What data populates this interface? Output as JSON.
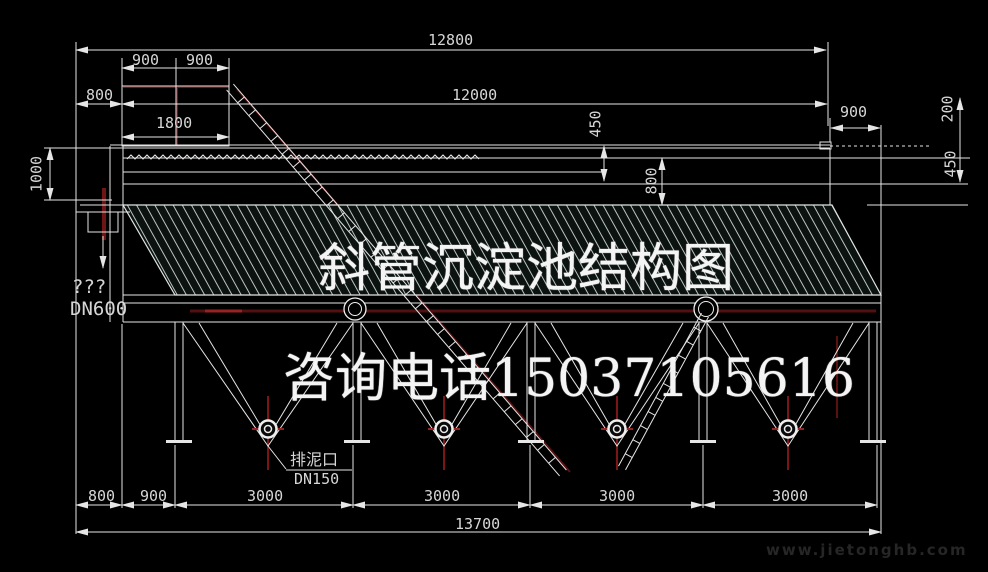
{
  "title": "斜管沉淀池结构图",
  "watermark": {
    "phone": "咨询电话15037105616",
    "site": "www.jietonghb.com"
  },
  "dimensions": {
    "overall_top": "12800",
    "inner_top": "12000",
    "platform_left": "900",
    "platform_right": "900",
    "platform_offset": "800",
    "platform_width": "1800",
    "left_depth": "1000",
    "mid_rim": "450",
    "mid_tube": "800",
    "right_offset": "900",
    "right_freeboard": "200",
    "right_trough": "450",
    "bottom_segments": [
      "800",
      "900",
      "3000",
      "3000",
      "3000",
      "3000"
    ],
    "overall_bottom": "13700"
  },
  "labels": {
    "inlet_unknown": "???",
    "inlet_pipe": "DN600",
    "drain_name": "排泥口",
    "drain_size": "DN150"
  }
}
